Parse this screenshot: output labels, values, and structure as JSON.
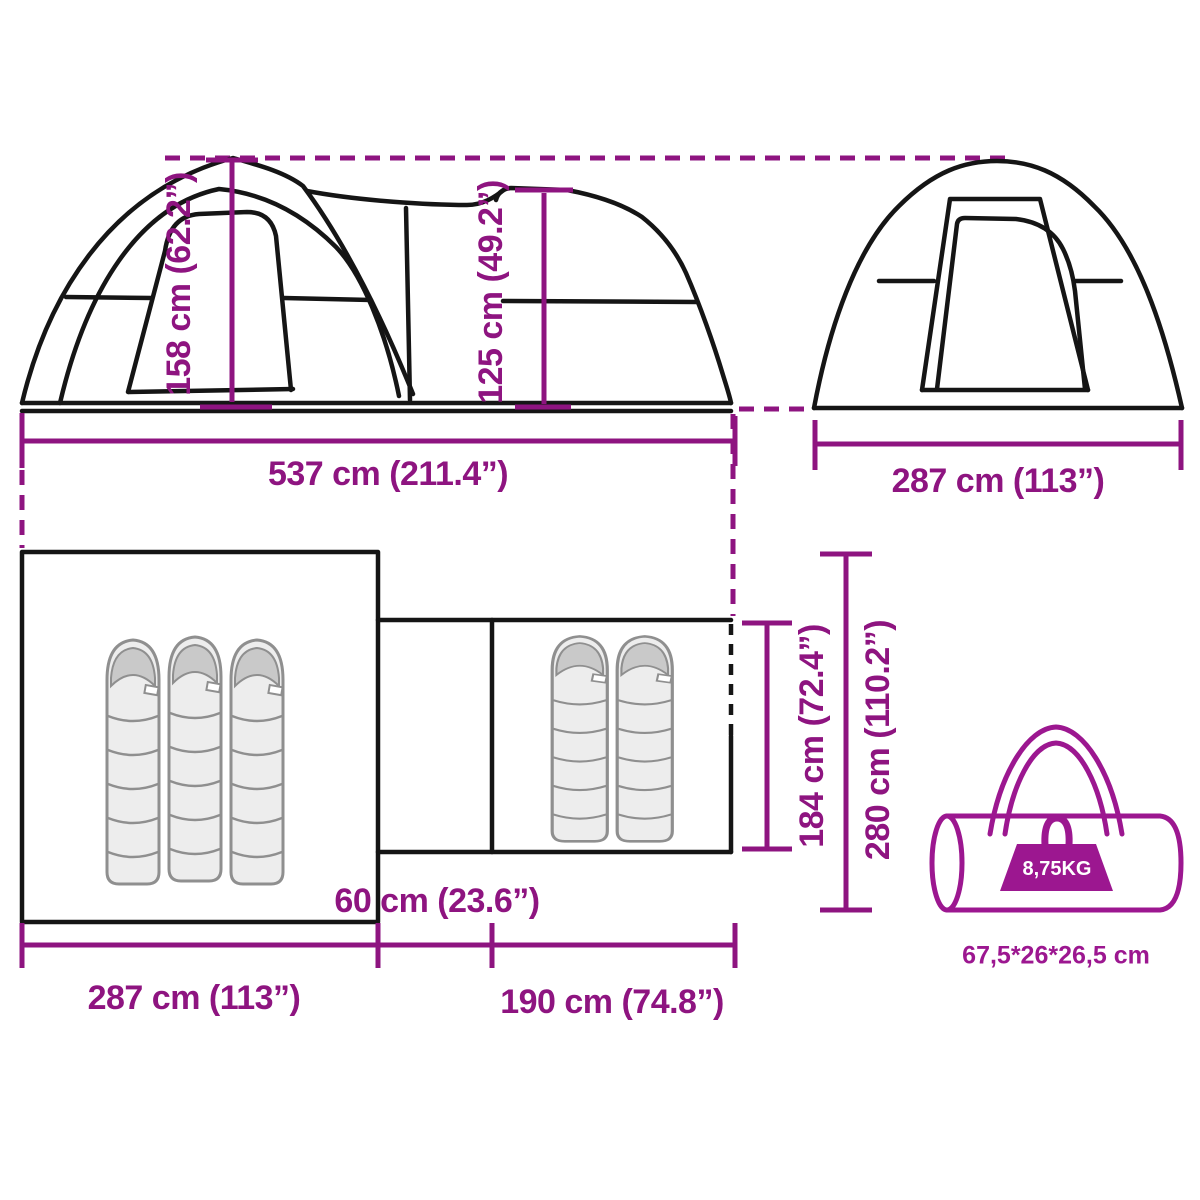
{
  "colors": {
    "accent": "#8e1480",
    "bag_accent": "#9c1790",
    "line_art": "#151515",
    "sleeping_bag_fill": "#ededed"
  },
  "side_view": {
    "peak_height": "158 cm (62.2”)",
    "rear_height": "125 cm (49.2”)",
    "total_length": "537 cm (211.4”)"
  },
  "front_view": {
    "width": "287 cm (113”)"
  },
  "floor_plan": {
    "bedroom_width": "287 cm (113”)",
    "porch_width": "190 cm (74.8”)",
    "connector_width": "60 cm (23.6”)",
    "inner_depth": "184 cm (72.4”)",
    "total_depth": "280 cm (110.2”)",
    "bedroom_sleeping_bags": 3,
    "porch_sleeping_bags": 2
  },
  "carry_bag": {
    "weight": "8,75KG",
    "size": "67,5*26*26,5 cm"
  }
}
